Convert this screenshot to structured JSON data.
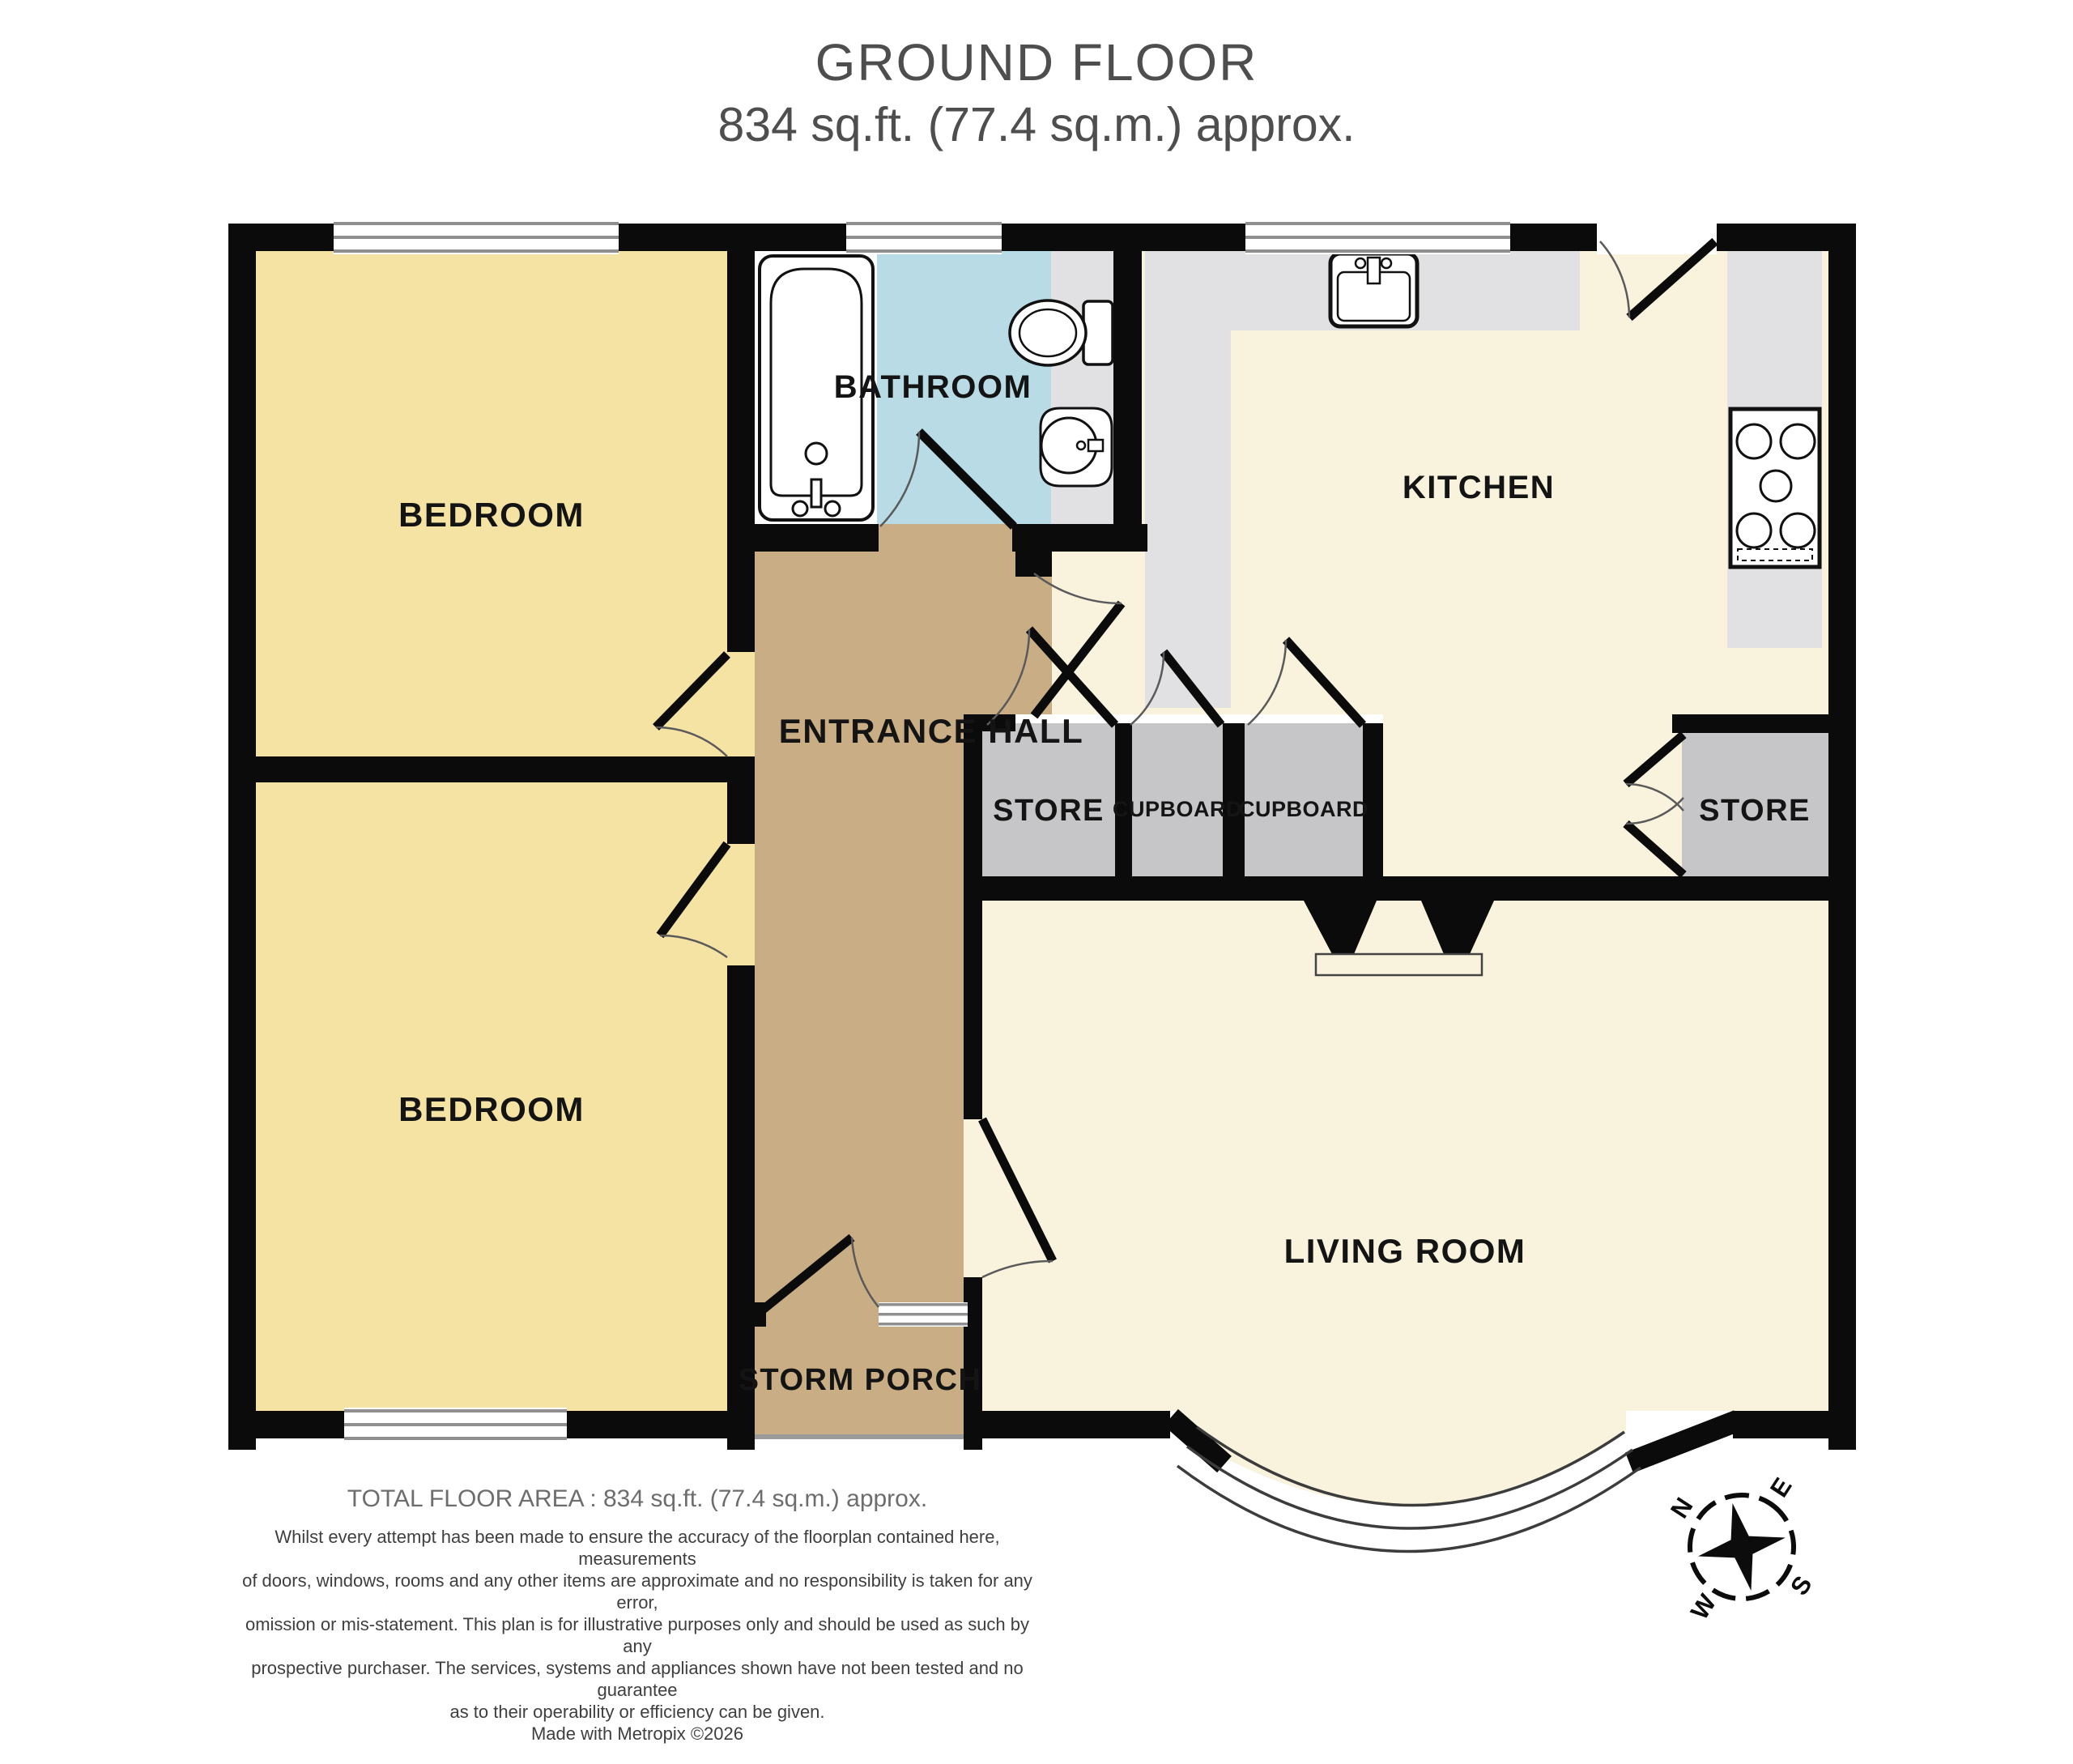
{
  "title": {
    "line1": "GROUND FLOOR",
    "line2": "834 sq.ft. (77.4 sq.m.) approx."
  },
  "rooms": {
    "bedroom_top": {
      "label": "BEDROOM"
    },
    "bedroom_bottom": {
      "label": "BEDROOM"
    },
    "bathroom": {
      "label": "BATHROOM"
    },
    "kitchen": {
      "label": "KITCHEN"
    },
    "entrance_hall": {
      "label": "ENTRANCE HALL"
    },
    "store_left": {
      "label": "STORE"
    },
    "cupboard_left": {
      "label": "CUPBOARD"
    },
    "cupboard_right": {
      "label": "CUPBOARD"
    },
    "store_right": {
      "label": "STORE"
    },
    "living_room": {
      "label": "LIVING ROOM"
    },
    "storm_porch": {
      "label": "STORM PORCH"
    }
  },
  "footer": {
    "total_area": "TOTAL FLOOR AREA : 834 sq.ft. (77.4 sq.m.) approx.",
    "disclaimer": [
      "Whilst every attempt has been made to ensure the accuracy of the floorplan contained here, measurements",
      "of doors, windows, rooms and any other items are approximate and no responsibility is taken for any error,",
      "omission or mis-statement. This plan is for illustrative purposes only and should be used as such by any",
      "prospective purchaser. The services, systems and appliances shown have not been tested and no guarantee",
      "as to their operability or efficiency can be given."
    ],
    "credit": "Made with Metropix ©2026"
  },
  "compass": {
    "n": "N",
    "e": "E",
    "s": "S",
    "w": "W"
  },
  "colors": {
    "bedroom_fill": "#F5E3A3",
    "bathroom_fill": "#B8DBE5",
    "hall_porch_fill": "#C9AD84",
    "kitchen_living_fill": "#F9F2DC",
    "storage_fill": "#C6C6C8",
    "counter_fill": "#E1E1E3",
    "wall": "#0B0B0B",
    "window_line": "#8F8F8F",
    "title_text": "#4E4E4E",
    "footer_text": "#6D6D6D",
    "disclaimer_text": "#3F3F3F"
  }
}
